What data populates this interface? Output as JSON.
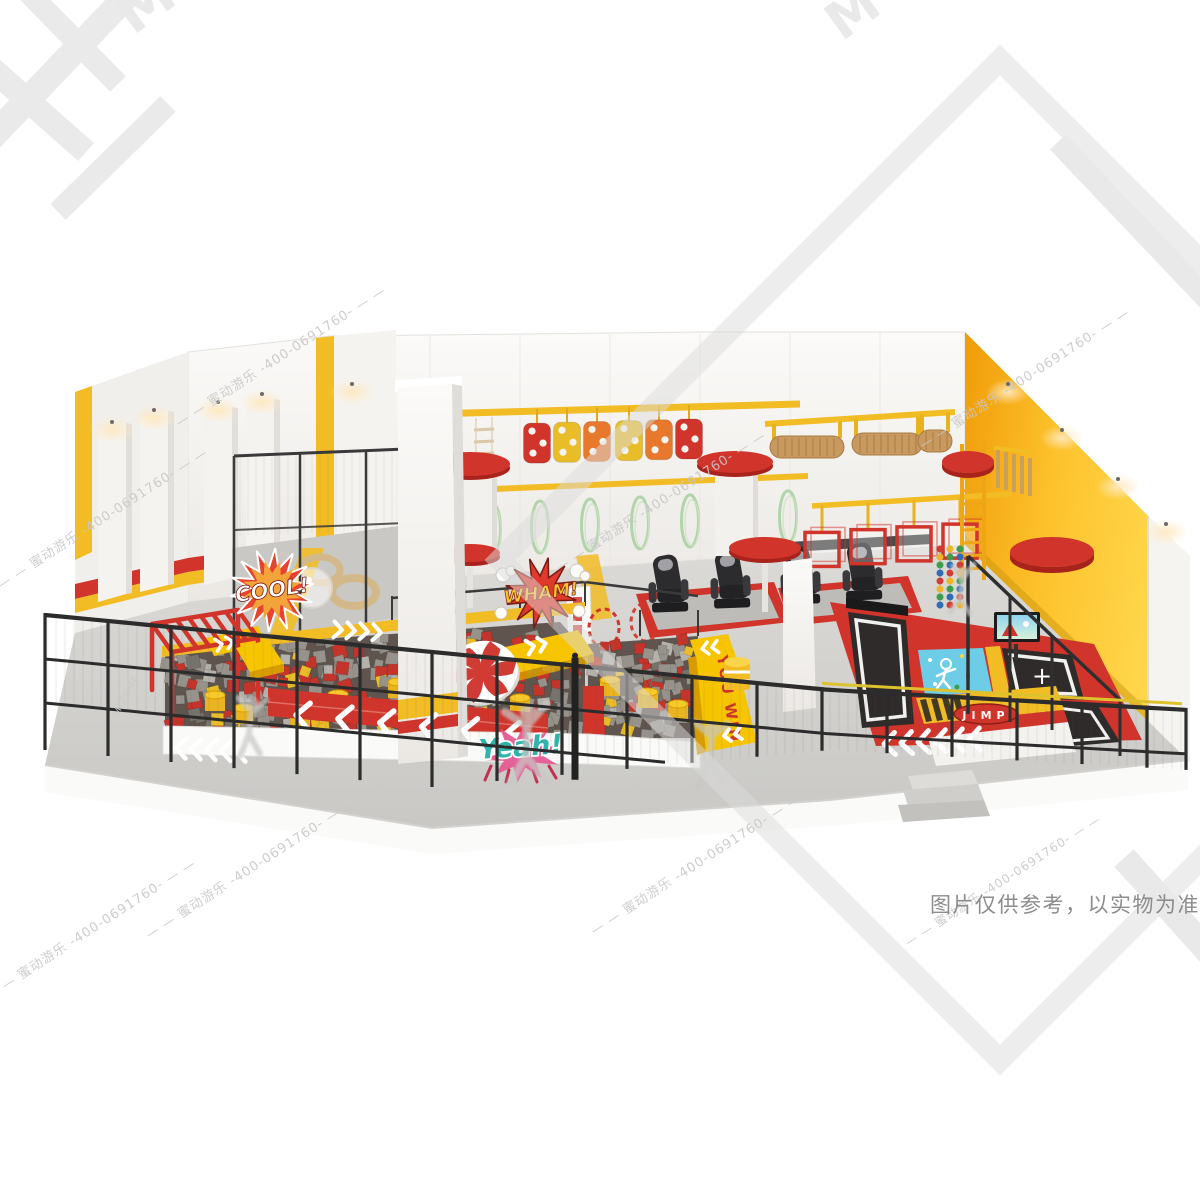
{
  "signs": {
    "cool": "COOL!",
    "wham": "WHAM!",
    "yeah": "Yeah!",
    "you_win": "YOU WIN",
    "jump_pill": "JIMP",
    "trampoline_plus": "+"
  },
  "watermark": {
    "brand_cn": "蜜动游乐",
    "brand_en": "MIZONE",
    "phone": "-400-0691760-",
    "line_text": "— — 蜜动游乐 -400-0691760- — —",
    "color": "#c8c8c8",
    "logo_color": "#e9e9e9"
  },
  "disclaimer": {
    "text": "图片仅供参考，以实物为准",
    "color": "#8c8c8c"
  },
  "palette": {
    "yellow": "#f2bc25",
    "yellowBright": "#f7c400",
    "amber": "#e9a00e",
    "red": "#d0342b",
    "redDark": "#a8231c",
    "orange": "#e8792c",
    "wall": "#f5f3f0",
    "wallShade": "#e7e4df",
    "floor": "#d2d1ce",
    "floorDark": "#c5c4c1",
    "fence": "#2c2c2c",
    "foamGray": "#97938c",
    "foamRed": "#c5342b",
    "foamYellow": "#e9bd27",
    "bedBlack": "#2e2b2a",
    "cyan": "#6ecde6",
    "tan": "#c99a5f",
    "green": "#a6cf9f",
    "pink": "#e45b92",
    "teal": "#2fb4ac",
    "glow": "#ffe3b0"
  }
}
